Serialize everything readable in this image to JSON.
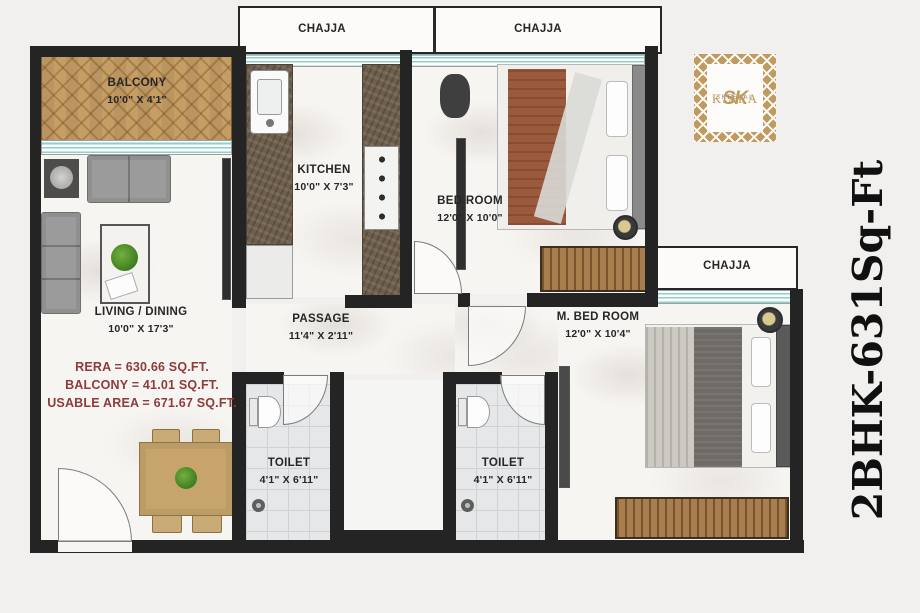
{
  "title": {
    "text": "2BHK-631Sq-Ft"
  },
  "logo": {
    "monogram": "SK",
    "subtitle": "SHEETAL",
    "brand": "KIARA"
  },
  "chajja": {
    "top_left": "CHAJJA",
    "top_right": "CHAJJA",
    "right": "CHAJJA"
  },
  "rooms": {
    "balcony": {
      "name": "BALCONY",
      "dims": "10'0\" X 4'1\""
    },
    "living": {
      "name": "LIVING / DINING",
      "dims": "10'0\" X 17'3\""
    },
    "kitchen": {
      "name": "KITCHEN",
      "dims": "10'0\" X 7'3\""
    },
    "bedroom": {
      "name": "BED ROOM",
      "dims": "12'0\" X 10'0\""
    },
    "master_bedroom": {
      "name": "M. BED ROOM",
      "dims": "12'0\" X 10'4\""
    },
    "passage": {
      "name": "PASSAGE",
      "dims": "11'4\" X 2'11\""
    },
    "toilet_1": {
      "name": "TOILET",
      "dims": "4'1\" X 6'11\""
    },
    "toilet_2": {
      "name": "TOILET",
      "dims": "4'1\" X 6'11\""
    }
  },
  "area_statement": {
    "rera": "RERA = 630.66 SQ.FT.",
    "balcony": "BALCONY = 41.01 SQ.FT.",
    "usable": "USABLE AREA = 671.67 SQ.FT."
  },
  "colors": {
    "brand_gold": "#c09a5e",
    "area_text": "#8e3b3b",
    "wall": "#242424",
    "balcony_wood": "#c59e66",
    "window_accent": "#8fcfce"
  }
}
